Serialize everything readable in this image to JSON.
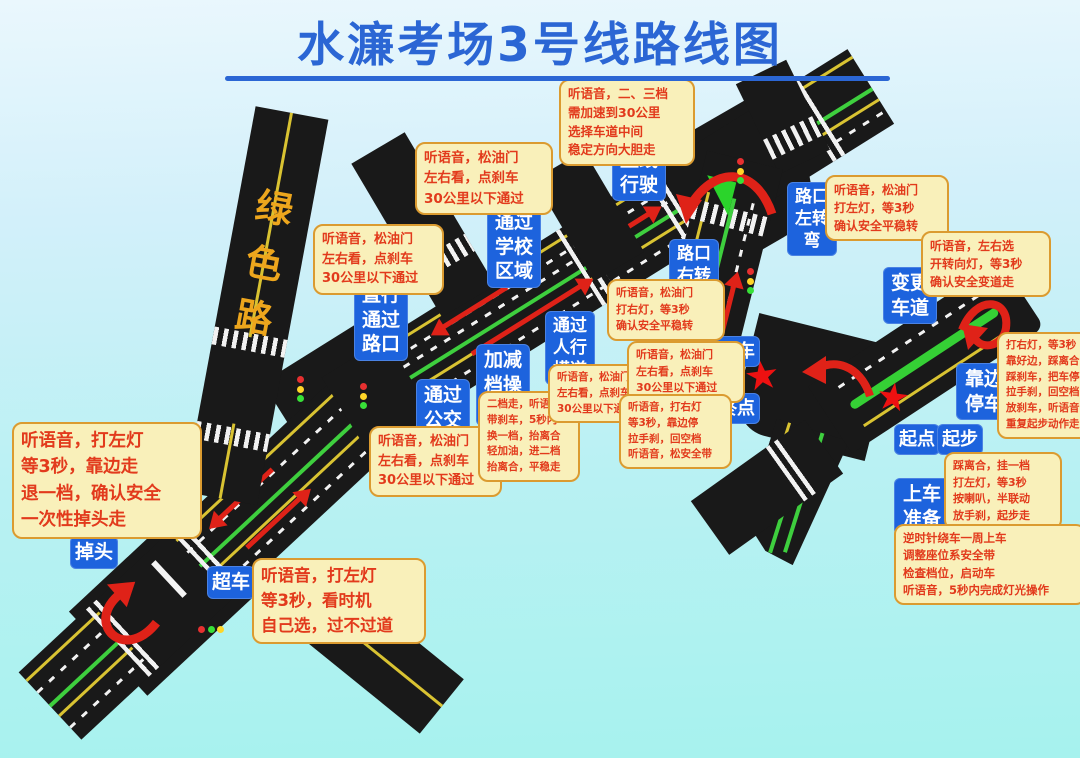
{
  "title": "水濂考场3号线路线图",
  "green_road_label": "绿色路",
  "colors": {
    "title_blue": "#2b66d4",
    "label_blue_bg": "#1d63dd",
    "note_bg": "#f9f0ba",
    "note_border": "#db9b30",
    "note_text": "#e23a1c",
    "road_black": "#191919",
    "lane_green": "#3ecf3e",
    "lane_yellow": "#d9c332",
    "arrow_red": "#df2218",
    "star_red": "#ee1111"
  },
  "star_symbol": "★",
  "blue_labels": [
    {
      "id": "straight-drive",
      "text": "直线行驶"
    },
    {
      "id": "school-zone",
      "text": "通过学校区域"
    },
    {
      "id": "straight-through-crossing",
      "text": "直行通过路口"
    },
    {
      "id": "bus-stop",
      "text": "通过公交车站"
    },
    {
      "id": "gear-operation",
      "text": "加减档操作"
    },
    {
      "id": "pedestrian-crossing",
      "text": "通过人行横道"
    },
    {
      "id": "right-turn-crossing",
      "text": "路口右转弯"
    },
    {
      "id": "left-turn-crossing",
      "text": "路口左转弯"
    },
    {
      "id": "lane-change",
      "text": "变更车道"
    },
    {
      "id": "meet-vehicle",
      "text": "会车"
    },
    {
      "id": "finish-point",
      "text": "终点"
    },
    {
      "id": "pull-over",
      "text": "靠边停车"
    },
    {
      "id": "start-point",
      "text": "起点"
    },
    {
      "id": "start-move",
      "text": "起步"
    },
    {
      "id": "boarding-prepare",
      "text": "上车准备"
    },
    {
      "id": "u-turn",
      "text": "掉头"
    },
    {
      "id": "overtake",
      "text": "超车"
    }
  ],
  "notes": [
    {
      "id": "speed-up",
      "text": "听语音，二、三档\n需加速到30公里\n选择车道中间\n稳定方向大胆走"
    },
    {
      "id": "school-pass",
      "text": "听语音，松油门\n左右看，点刹车\n30公里以下通过"
    },
    {
      "id": "crossing-pass",
      "text": "听语音，松油门\n左右看，点刹车\n30公里以下通过"
    },
    {
      "id": "u-turn-steps",
      "text": "听语音，打左灯\n等3秒，靠边走\n退一档，确认安全\n一次性掉头走"
    },
    {
      "id": "overtake-steps",
      "text": "听语音，打左灯\n等3秒，看时机\n自己选，过不过道"
    },
    {
      "id": "bus-stop-pass",
      "text": "听语音，松油门\n左右看，点刹车\n30公里以下通过"
    },
    {
      "id": "gear-steps",
      "text": "二档走，听语音\n带刹车，5秒内\n换一档，抬离合\n轻加油，进二档\n抬离合，平稳走"
    },
    {
      "id": "crosswalk-pass",
      "text": "听语音，松油门\n左右看，点刹车\n30公里以下通过"
    },
    {
      "id": "right-turn-steps",
      "text": "听语音，松油门\n打右灯，等3秒\n确认安全平稳转"
    },
    {
      "id": "meet-pass",
      "text": "听语音，松油门\n左右看，点刹车\n30公里以下通过"
    },
    {
      "id": "finish-stop-steps",
      "text": "听语音，打右灯\n等3秒，靠边停\n拉手刹，回空档\n听语音，松安全带"
    },
    {
      "id": "left-turn-steps",
      "text": "听语音，松油门\n打左灯，等3秒\n确认安全平稳转"
    },
    {
      "id": "lane-change-steps",
      "text": "听语音，左右选\n开转向灯，等3秒\n确认安全变道走"
    },
    {
      "id": "pull-over-steps",
      "text": "打右灯，等3秒\n靠好边，踩离合\n踩刹车，把车停\n拉手刹，回空档\n放刹车，听语音\n重复起步动作走"
    },
    {
      "id": "start-move-steps",
      "text": "踩离合，挂一档\n打左灯，等3秒\n按喇叭，半联动\n放手刹，起步走"
    },
    {
      "id": "boarding-steps",
      "text": "逆时针绕车一周上车\n调整座位系安全带\n检查档位，启动车\n听语音，5秒内完成灯光操作"
    }
  ]
}
